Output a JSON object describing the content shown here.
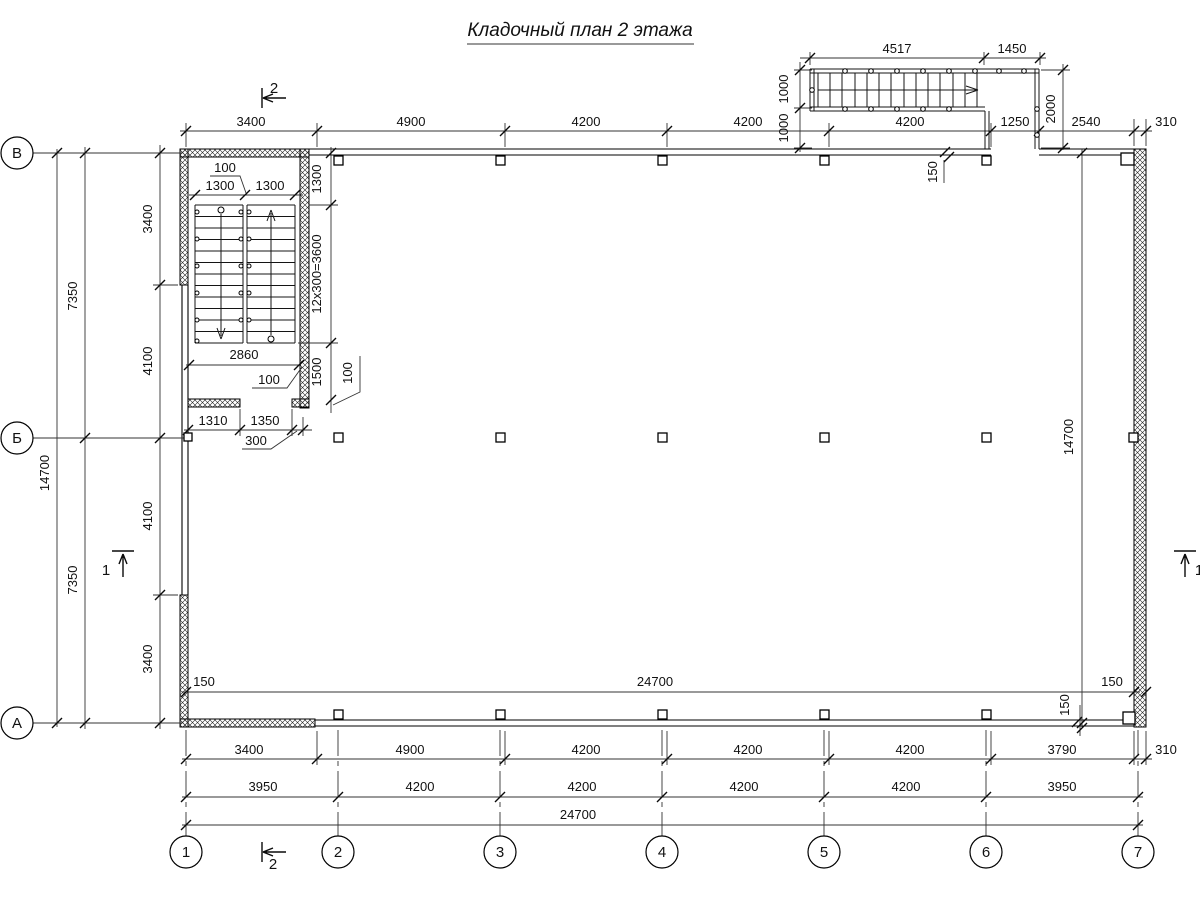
{
  "title": "Кладочный план 2 этажа",
  "axes": {
    "rows": [
      "В",
      "Б",
      "А"
    ],
    "cols": [
      "1",
      "2",
      "3",
      "4",
      "5",
      "6",
      "7"
    ]
  },
  "sections": {
    "s2": "2",
    "s1": "1"
  },
  "dims": {
    "top": [
      "3400",
      "4900",
      "4200",
      "4200",
      "4200",
      "1250",
      "2540",
      "310"
    ],
    "stair_top": [
      "4517",
      "1450"
    ],
    "stair_left": [
      "1000",
      "1000"
    ],
    "stair_right": "2000",
    "wall_150": "150",
    "left_col1": "14700",
    "left_col2": [
      "7350",
      "7350"
    ],
    "left_col3": [
      "3400",
      "4100",
      "4100",
      "3400"
    ],
    "right_col": "14700",
    "stairwell": {
      "gap": "100",
      "flights": [
        "1300",
        "1300"
      ],
      "first": "1300",
      "run": "12x300=3600",
      "width": "2860",
      "wall_a": "100",
      "landing": "1500",
      "wall_b": "100",
      "door": [
        "1310",
        "1350"
      ],
      "pier": "300"
    },
    "inner_bottom": {
      "left": "150",
      "total": "24700",
      "right": "150",
      "wall": "150"
    },
    "row1": [
      "3400",
      "4900",
      "4200",
      "4200",
      "4200",
      "3790",
      "310"
    ],
    "row2": [
      "3950",
      "4200",
      "4200",
      "4200",
      "4200",
      "3950"
    ],
    "row3": "24700"
  }
}
